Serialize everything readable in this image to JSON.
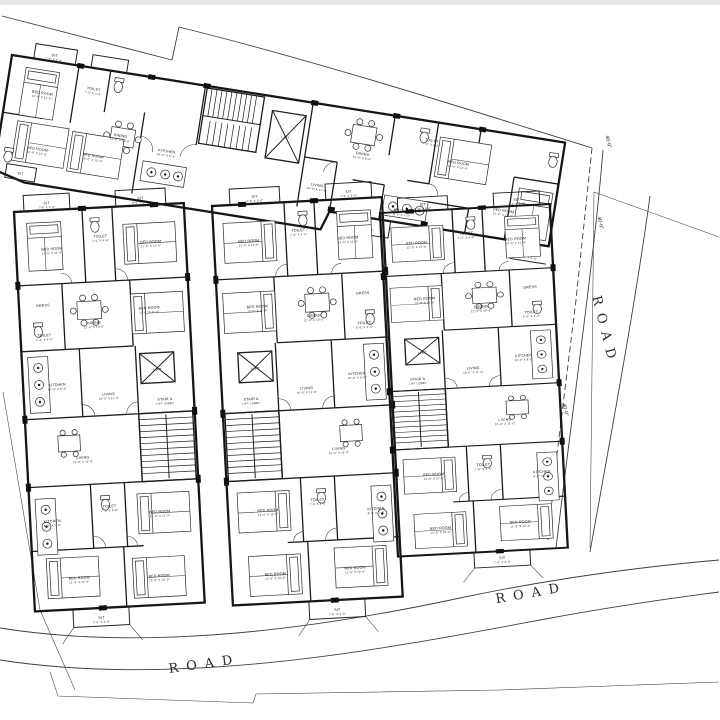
{
  "site": {
    "road_label": "ROAD",
    "dimension_label": "40'-0\"",
    "labels": [
      {
        "t": "ROAD",
        "x": 205,
        "y": 668,
        "r": -8,
        "c": "road"
      },
      {
        "t": "ROAD",
        "x": 532,
        "y": 597,
        "r": -10,
        "c": "road"
      },
      {
        "t": "ROAD",
        "x": 601,
        "y": 332,
        "r": 76,
        "c": "road"
      },
      {
        "t": "40'-0\"",
        "x": 607,
        "y": 142,
        "r": 76,
        "c": "dim"
      },
      {
        "t": "40'-0\"",
        "x": 599,
        "y": 223,
        "r": 76,
        "c": "dim"
      },
      {
        "t": "40'-0\"",
        "x": 564,
        "y": 410,
        "r": 76,
        "c": "dim"
      }
    ]
  },
  "wing": {
    "labels": [
      {
        "t": "SIT",
        "d": "7'-6\" X 3'-0\"",
        "x": 42,
        "y": -5
      },
      {
        "t": "SIT",
        "x": 27,
        "y": 117
      },
      {
        "t": "BED ROOM",
        "d": "12'-0\" X 11'-0\"",
        "x": 36,
        "y": 34
      },
      {
        "t": "TOILET",
        "d": "7'-0\" X 4'-0\"",
        "x": 86,
        "y": 22
      },
      {
        "t": "DINING",
        "d": "12'-0\" X 10'-0\"",
        "x": 120,
        "y": 64
      },
      {
        "t": "KITCHEN",
        "d": "10'-0\" X 8'-0\"",
        "x": 168,
        "y": 72
      },
      {
        "t": "BED ROOM",
        "d": "11'-0\" X 12'-6\"",
        "x": 40,
        "y": 90
      },
      {
        "t": "BED ROOM",
        "d": "10'-0\" X 12'-0\"",
        "x": 96,
        "y": 88
      },
      {
        "t": "LIFT",
        "x": 283,
        "y": 40
      },
      {
        "t": "DINING",
        "d": "10'-0\" X 8'-6\"",
        "x": 362,
        "y": 44
      },
      {
        "t": "LIVING",
        "d": "16'-6\" X 11'-0\"",
        "x": 322,
        "y": 82
      },
      {
        "t": "KITCHEN",
        "d": "8'-0\" X 7'-0\"",
        "x": 410,
        "y": 94
      },
      {
        "t": "TOILET",
        "d": "7'-0\" X 4'-0\"",
        "x": 428,
        "y": 20
      },
      {
        "t": "BED ROOM",
        "d": "12'-0\" X 11'-0\"",
        "x": 458,
        "y": 38
      },
      {
        "t": "BED ROOM",
        "d": "11'-0\" X 12'-0\"",
        "x": 510,
        "y": 78
      },
      {
        "t": "SIT",
        "d": "8'-0\" X 3'-0\"",
        "x": 376,
        "y": 114
      },
      {
        "t": "SIT",
        "d": "7'-6\" X 3'-0\"",
        "x": 542,
        "y": 116
      }
    ]
  },
  "block_left": {
    "labels": [
      {
        "t": "SIT",
        "d": "7'-6\" X 3'-0\"",
        "x": 33,
        "y": -6
      },
      {
        "t": "SIT",
        "d": "8'-0\" X 3'-0\"",
        "x": 127,
        "y": -6
      },
      {
        "t": "BED ROOM",
        "d": "12'-6\" X 11'-0\"",
        "x": 36,
        "y": 40
      },
      {
        "t": "TOILET",
        "d": "7'-0\" X 4'-6\"",
        "x": 85,
        "y": 30
      },
      {
        "t": "BED ROOM",
        "d": "11'-0\" X 12'-0\"",
        "x": 135,
        "y": 38
      },
      {
        "t": "DRESS",
        "x": 24,
        "y": 96
      },
      {
        "t": "TOILET",
        "d": "6'-6\" X 4'-0\"",
        "x": 24,
        "y": 126
      },
      {
        "t": "DINING",
        "d": "12'-0\" X 10'-0\"",
        "x": 74,
        "y": 116
      },
      {
        "t": "BED ROOM",
        "d": "12'-0\" X 11'-6\"",
        "x": 130,
        "y": 104
      },
      {
        "t": "KITCHEN",
        "d": "10'-0\" X 8'-0\"",
        "x": 34,
        "y": 176
      },
      {
        "t": "LIVING",
        "d": "16'-0\" X 11'-0\"",
        "x": 85,
        "y": 188
      },
      {
        "t": "LIFT",
        "x": 135,
        "y": 166
      },
      {
        "t": "STAIR &",
        "d": "LIFT LOBBY",
        "x": 141,
        "y": 196
      },
      {
        "t": "LIVING",
        "d": "15'-0\" X 11'-0\"",
        "x": 56,
        "y": 250
      },
      {
        "t": "BED ROOM",
        "d": "12'-0\" X 11'-0\"",
        "x": 130,
        "y": 308
      },
      {
        "t": "TOILET",
        "d": "7'-0\" X 4'-0\"",
        "x": 80,
        "y": 300
      },
      {
        "t": "KITCHEN",
        "d": "8'-0\" X 7'-6\"",
        "x": 22,
        "y": 312
      },
      {
        "t": "BED ROOM",
        "d": "11'-0\" X 12'-0\"",
        "x": 46,
        "y": 370
      },
      {
        "t": "BED ROOM",
        "d": "12'-0\" X 10'-0\"",
        "x": 126,
        "y": 372
      },
      {
        "t": "SIT",
        "d": "7'-6\" X 3'-0\"",
        "x": 66,
        "y": 411
      }
    ]
  },
  "block_middle": {
    "labels": [
      {
        "t": "SIT",
        "d": "7'-6\" X 3'-0\"",
        "x": 137,
        "y": -6
      },
      {
        "t": "SIT",
        "d": "8'-0\" X 3'-0\"",
        "x": 43,
        "y": -6
      },
      {
        "t": "BED ROOM",
        "d": "12'-6\" X 11'-0\"",
        "x": 134,
        "y": 40
      },
      {
        "t": "TOILET",
        "d": "7'-0\" X 4'-6\"",
        "x": 85,
        "y": 30
      },
      {
        "t": "BED ROOM",
        "d": "11'-0\" X 12'-0\"",
        "x": 35,
        "y": 38
      },
      {
        "t": "DRESS",
        "x": 146,
        "y": 96
      },
      {
        "t": "TOILET",
        "d": "6'-6\" X 4'-0\"",
        "x": 146,
        "y": 126
      },
      {
        "t": "DINING",
        "d": "12'-0\" X 10'-0\"",
        "x": 96,
        "y": 116
      },
      {
        "t": "BED ROOM",
        "d": "12'-0\" X 11'-6\"",
        "x": 40,
        "y": 104
      },
      {
        "t": "KITCHEN",
        "d": "10'-0\" X 8'-0\"",
        "x": 136,
        "y": 176
      },
      {
        "t": "LIVING",
        "d": "16'-0\" X 11'-0\"",
        "x": 85,
        "y": 188
      },
      {
        "t": "LIFT",
        "x": 35,
        "y": 166
      },
      {
        "t": "STAIR &",
        "d": "LIFT LOBBY",
        "x": 29,
        "y": 196
      },
      {
        "t": "LIVING",
        "d": "15'-0\" X 11'-0\"",
        "x": 114,
        "y": 250
      },
      {
        "t": "BED ROOM",
        "d": "12'-0\" X 11'-0\"",
        "x": 40,
        "y": 308
      },
      {
        "t": "TOILET",
        "d": "7'-0\" X 4'-0\"",
        "x": 90,
        "y": 300
      },
      {
        "t": "KITCHEN",
        "d": "8'-0\" X 7'-6\"",
        "x": 148,
        "y": 312
      },
      {
        "t": "BED ROOM",
        "d": "11'-0\" X 12'-0\"",
        "x": 124,
        "y": 370
      },
      {
        "t": "BED ROOM",
        "d": "12'-0\" X 10'-0\"",
        "x": 44,
        "y": 372
      },
      {
        "t": "SIT",
        "d": "7'-6\" X 3'-0\"",
        "x": 104,
        "y": 411
      }
    ]
  },
  "block_right": {
    "labels": [
      {
        "t": "SIT",
        "d": "7'-6\" X 3'-0\"",
        "x": 137,
        "y": -5
      },
      {
        "t": "SIT",
        "d": "8'-0\" X 3'-0\"",
        "x": 43,
        "y": -5
      },
      {
        "t": "BED ROOM",
        "d": "12'-6\" X 11'-0\"",
        "x": 134,
        "y": 34
      },
      {
        "t": "TOILET",
        "d": "7'-0\" X 4'-6\"",
        "x": 85,
        "y": 26
      },
      {
        "t": "BED ROOM",
        "d": "11'-0\" X 12'-0\"",
        "x": 35,
        "y": 33
      },
      {
        "t": "DRESS",
        "x": 146,
        "y": 83
      },
      {
        "t": "TOILET",
        "d": "6'-6\" X 4'-0\"",
        "x": 146,
        "y": 108
      },
      {
        "t": "DINING",
        "d": "12'-0\" X 10'-0\"",
        "x": 96,
        "y": 100
      },
      {
        "t": "BED ROOM",
        "d": "12'-0\" X 11'-6\"",
        "x": 40,
        "y": 89
      },
      {
        "t": "KITCHEN",
        "d": "10'-0\" X 8'-0\"",
        "x": 136,
        "y": 151
      },
      {
        "t": "LIVING",
        "d": "16'-0\" X 11'-0\"",
        "x": 85,
        "y": 161
      },
      {
        "t": "LIFT",
        "x": 35,
        "y": 143
      },
      {
        "t": "STAIR &",
        "d": "LIFT LOBBY",
        "x": 29,
        "y": 169
      },
      {
        "t": "LIVING",
        "d": "15'-0\" X 11'-0\"",
        "x": 114,
        "y": 214
      },
      {
        "t": "BED ROOM",
        "d": "12'-0\" X 11'-0\"",
        "x": 40,
        "y": 265
      },
      {
        "t": "TOILET",
        "d": "7'-0\" X 4'-0\"",
        "x": 90,
        "y": 258
      },
      {
        "t": "KITCHEN",
        "d": "8'-0\" X 7'-6\"",
        "x": 148,
        "y": 268
      },
      {
        "t": "BED ROOM",
        "d": "11'-0\" X 12'-0\"",
        "x": 124,
        "y": 317
      },
      {
        "t": "BED ROOM",
        "d": "12'-0\" X 10'-0\"",
        "x": 44,
        "y": 319
      },
      {
        "t": "SIT",
        "d": "7'-6\" X 3'-0\"",
        "x": 104,
        "y": 352
      }
    ]
  }
}
